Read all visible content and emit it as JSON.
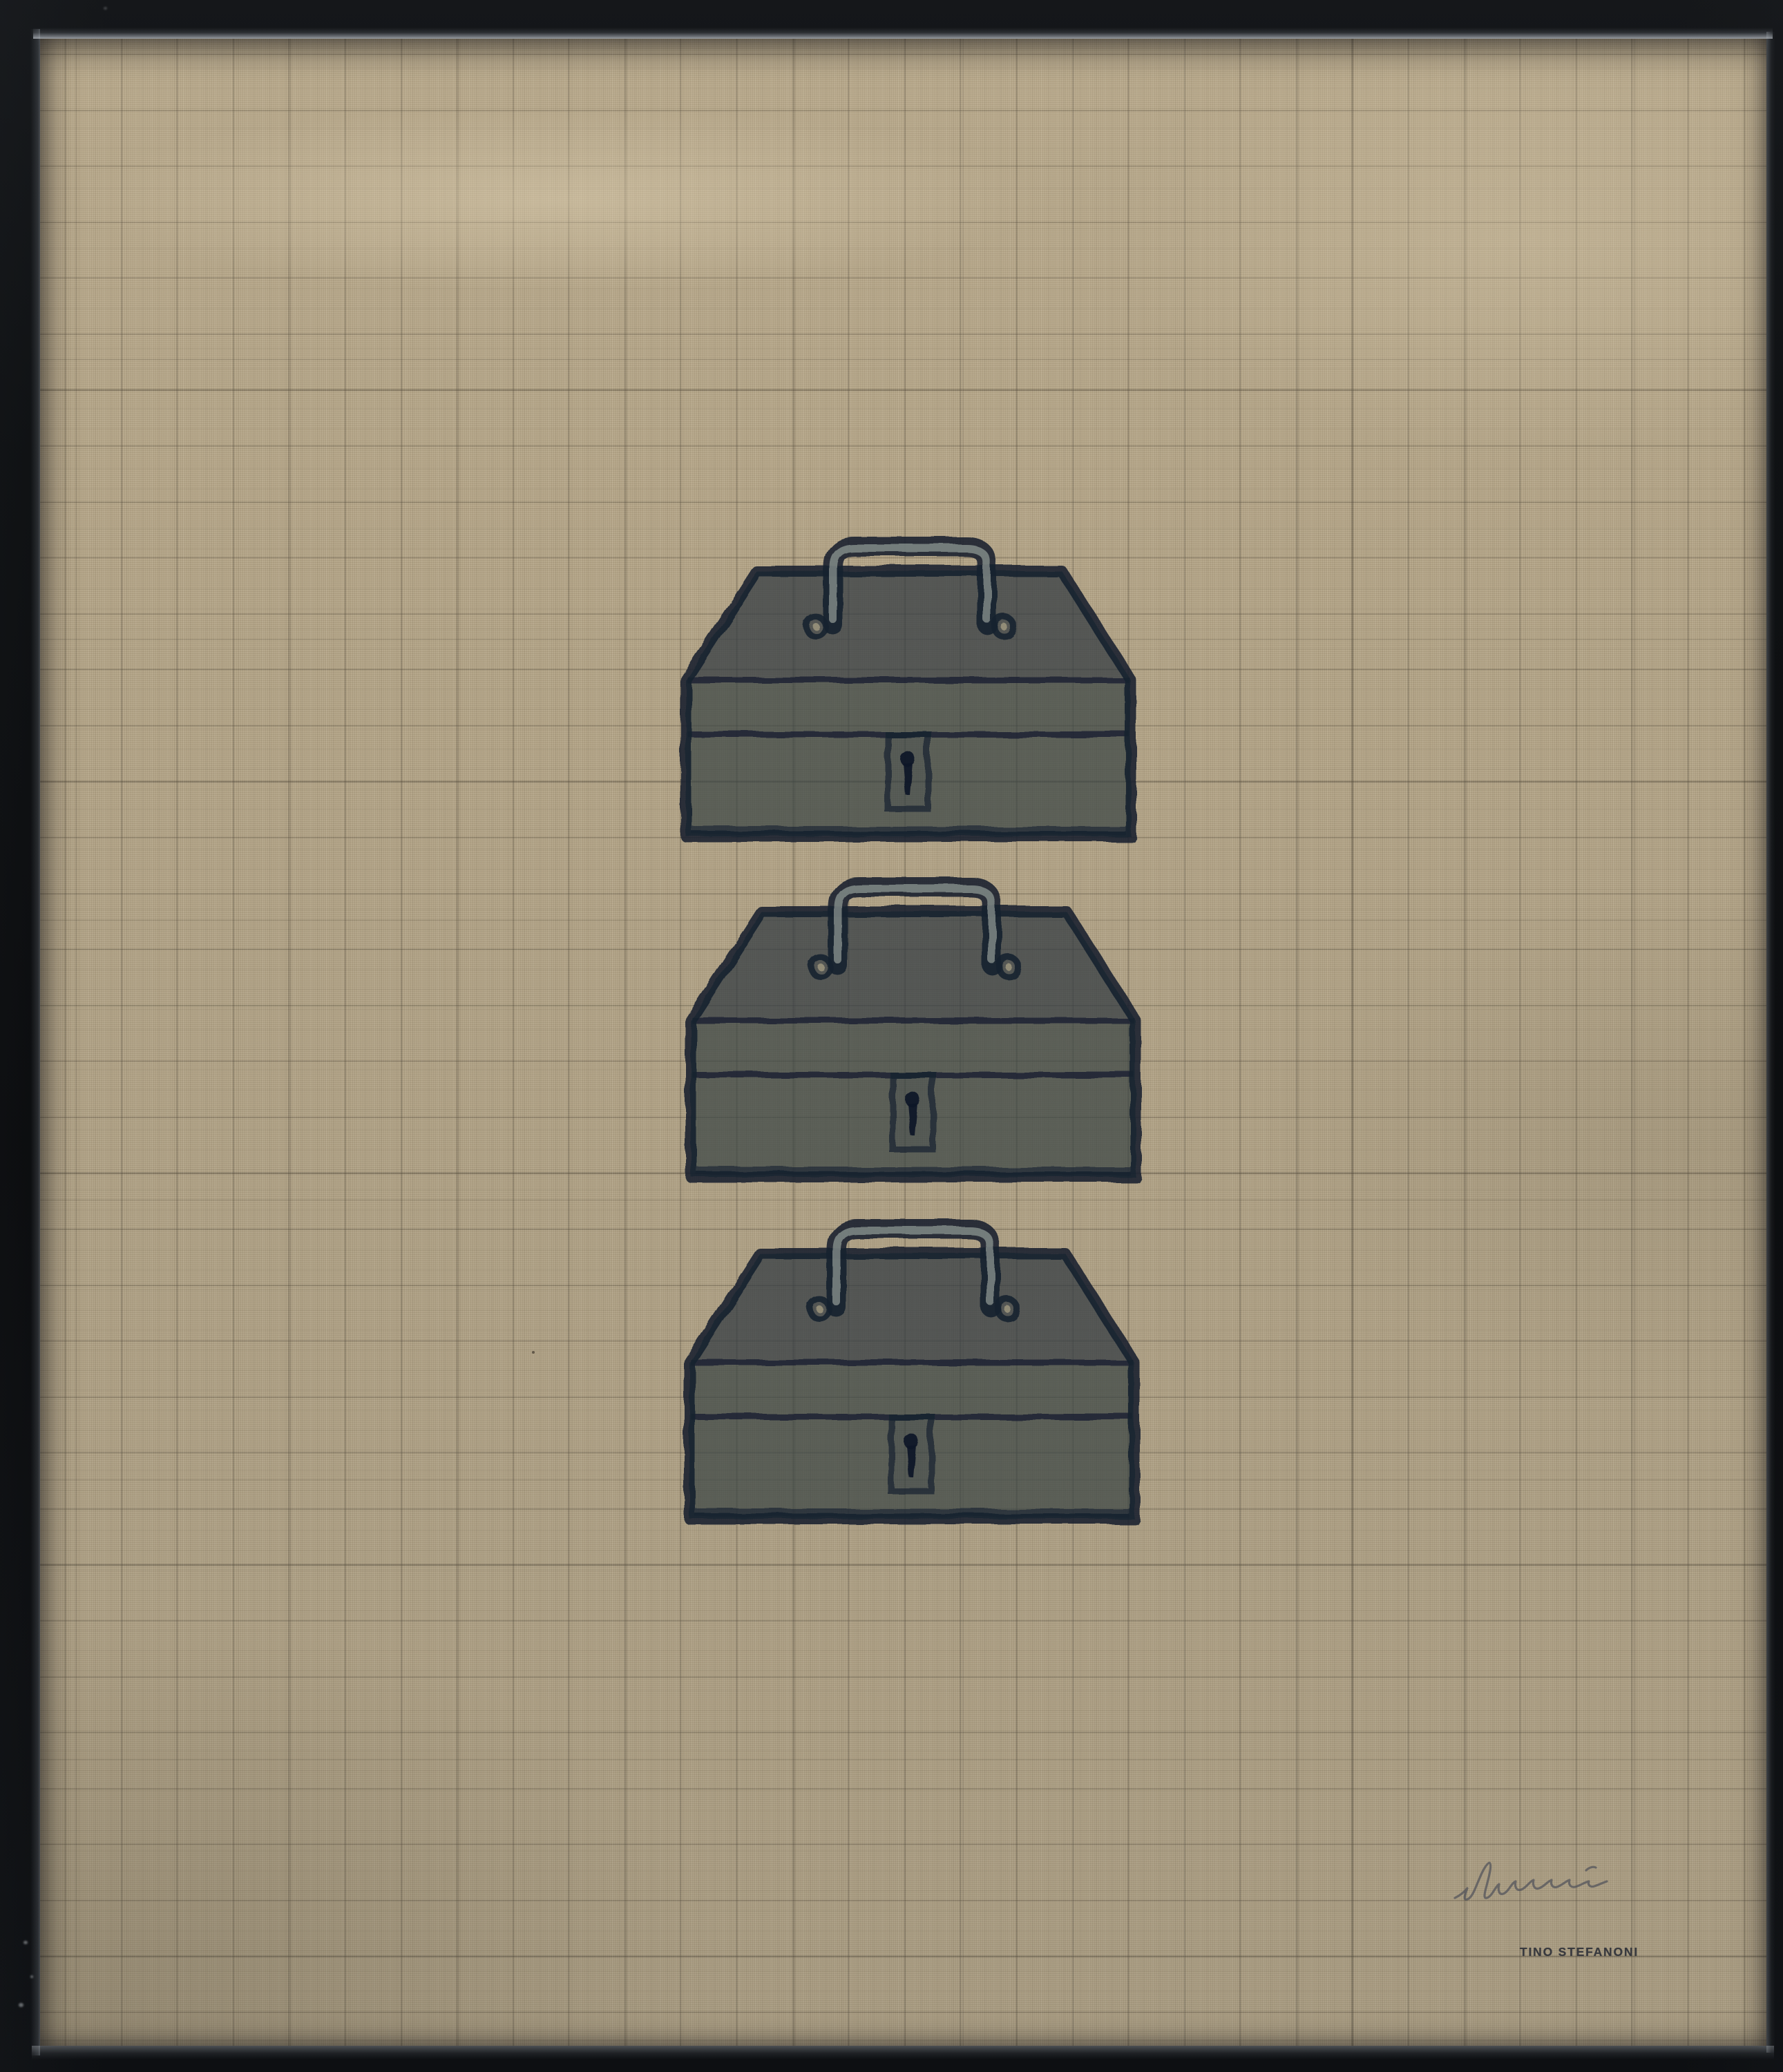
{
  "artwork": {
    "signature_stamp": "TINO STEFANONI",
    "toolbox_count": 3,
    "toolboxes": [
      {
        "label": "toolbox"
      },
      {
        "label": "toolbox"
      },
      {
        "label": "toolbox"
      }
    ]
  },
  "colors": {
    "page_bg": "#07080a",
    "frame": "#0e1013",
    "frame_highlight": "#aeb6bc",
    "canvas": "#b3a487",
    "grid_line": "#4c4436",
    "box_fill": "#364244",
    "box_outline": "#16202f",
    "handle_core": "#a8b0a8",
    "ring_hole": "#c4b896",
    "keyhole": "#0e1626",
    "stamp_text": "#303239",
    "signature_ink": "#50525a",
    "scuff": "#cfd4d8",
    "fleck": "#2e281f"
  }
}
